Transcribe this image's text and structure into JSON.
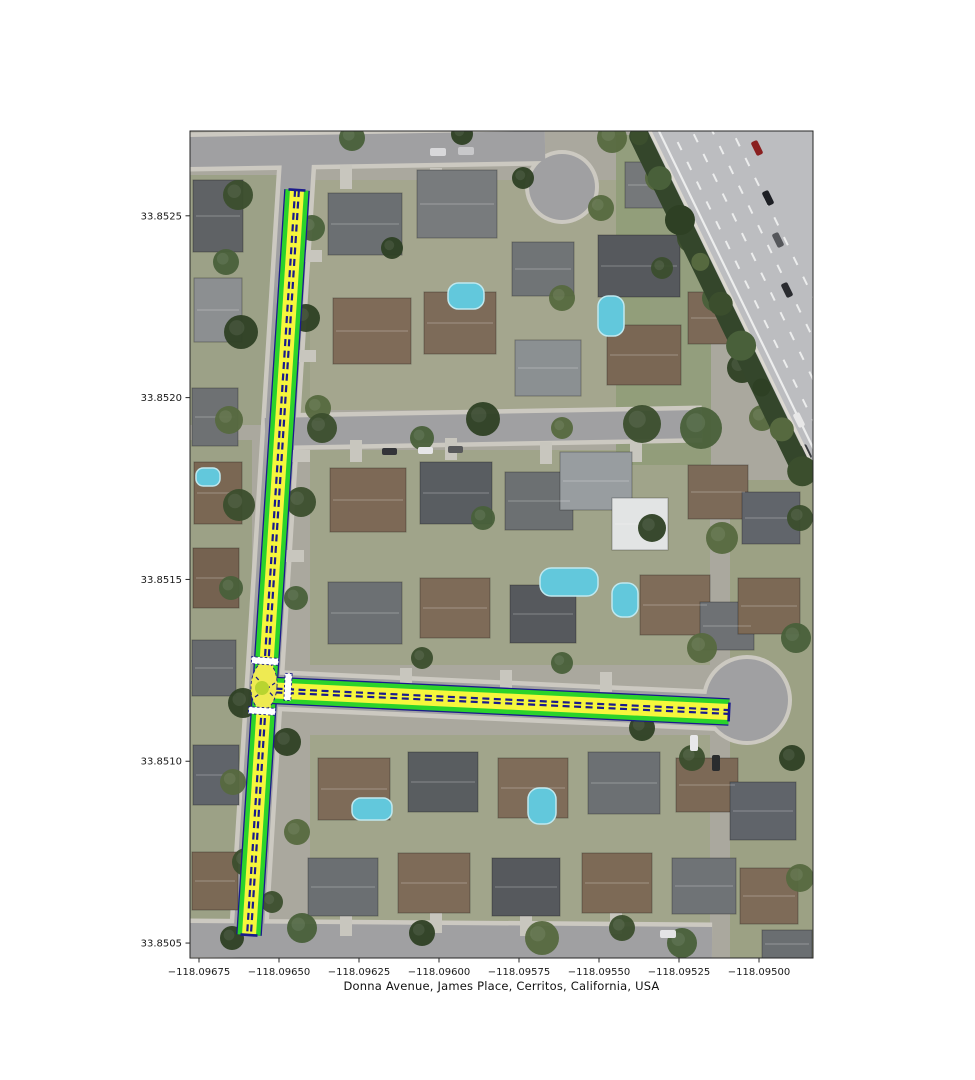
{
  "figure": {
    "width": 975,
    "height": 1080,
    "background": "#ffffff",
    "xlabel": "Donna Avenue, James Place, Cerritos, California, USA"
  },
  "axes": {
    "plot_rect": [
      190,
      131,
      623,
      827
    ],
    "frame_color": "#262626",
    "tick_color": "#262626",
    "label_color": "#1a1a1a",
    "tick_font_size": 10,
    "lon_range": [
      -118.0967781,
      -118.0948313
    ],
    "lat_range": [
      33.8504589,
      33.8527332
    ],
    "x_ticks": {
      "values": [
        -118.09675,
        -118.0965,
        -118.09625,
        -118.096,
        -118.09575,
        -118.0955,
        -118.09525,
        -118.095
      ],
      "labels": [
        "−118.09675",
        "−118.09650",
        "−118.09625",
        "−118.09600",
        "−118.09575",
        "−118.09550",
        "−118.09525",
        "−118.09500"
      ]
    },
    "y_ticks": {
      "values": [
        33.8525,
        33.852,
        33.8515,
        33.851,
        33.8505
      ],
      "labels": [
        "33.8525",
        "33.8520",
        "33.8515",
        "33.8510",
        "33.8505"
      ]
    }
  },
  "network": {
    "colors": {
      "outline": "#1a1a8c",
      "casing": "#2bd32b",
      "lane": "#f6f63c",
      "divider": "#1a1a8c",
      "crosswalk": "#ffffff",
      "junction_fill": "#eeea52",
      "node_fill": "#b8d430"
    },
    "roads": [
      {
        "id": "donna",
        "name": "Donna Avenue",
        "from": [
          297,
          190
        ],
        "to": [
          249,
          935
        ],
        "width": 23
      },
      {
        "id": "james",
        "name": "James Place",
        "from": [
          264,
          690
        ],
        "to": [
          729,
          712
        ],
        "width": 25
      }
    ],
    "junction": {
      "cx": 264,
      "cy": 686,
      "rx": 13,
      "ry": 24,
      "node_cx": 262,
      "node_cy": 688,
      "node_r": 7,
      "connectors": [
        [
          [
            255,
            697
          ],
          [
            275,
            683
          ]
        ],
        [
          [
            256,
            677
          ],
          [
            273,
            696
          ]
        ]
      ]
    },
    "crosswalks": [
      {
        "road": "donna",
        "cx": 265,
        "cy": 661,
        "len": 27,
        "thick": 7
      },
      {
        "road": "james",
        "cx": 288,
        "cy": 687,
        "len": 27,
        "thick": 7
      },
      {
        "road": "donna",
        "cx": 262,
        "cy": 711,
        "len": 27,
        "thick": 7
      }
    ]
  },
  "basemap": {
    "base_color": "#aaa89e",
    "asphalt_color": "#a0a0a2",
    "sidewalk_color": "#ccc9c1",
    "driveway_color": "#c8c6be",
    "pool_color": "#62c8dc",
    "pool_edge": "#bfe8ef",
    "lawns": [
      [
        190,
        175,
        120,
        250,
        "#9aa083"
      ],
      [
        310,
        180,
        340,
        230,
        "#a3a68b"
      ],
      [
        310,
        450,
        400,
        215,
        "#9fa386"
      ],
      [
        310,
        735,
        400,
        190,
        "#a0a487"
      ],
      [
        616,
        135,
        95,
        330,
        "#8f9c77"
      ],
      [
        730,
        480,
        83,
        478,
        "#9aa07f"
      ],
      [
        190,
        440,
        62,
        490,
        "#9aa081"
      ]
    ],
    "streets": [
      {
        "pts": [
          [
            190,
            152
          ],
          [
            545,
            146
          ]
        ],
        "w": 30
      },
      {
        "pts": [
          [
            298,
            145
          ],
          [
            247,
            958
          ]
        ],
        "w": 30
      },
      {
        "pts": [
          [
            265,
            432
          ],
          [
            702,
            424
          ]
        ],
        "w": 28
      },
      {
        "pts": [
          [
            264,
            690
          ],
          [
            728,
            711
          ]
        ],
        "w": 32
      },
      {
        "pts": [
          [
            190,
            940
          ],
          [
            712,
            944
          ]
        ],
        "w": 34
      }
    ],
    "culdesacs": [
      {
        "cx": 562,
        "cy": 187,
        "r": 33
      },
      {
        "cx": 747,
        "cy": 700,
        "r": 41
      }
    ],
    "driveways": [
      [
        340,
        165,
        12,
        24
      ],
      [
        430,
        168,
        12,
        22
      ],
      [
        350,
        440,
        12,
        22
      ],
      [
        445,
        438,
        12,
        22
      ],
      [
        540,
        442,
        12,
        22
      ],
      [
        630,
        440,
        12,
        22
      ],
      [
        400,
        668,
        12,
        20
      ],
      [
        500,
        670,
        12,
        20
      ],
      [
        600,
        672,
        12,
        20
      ],
      [
        340,
        910,
        12,
        26
      ],
      [
        430,
        907,
        12,
        26
      ],
      [
        520,
        910,
        12,
        26
      ],
      [
        610,
        908,
        12,
        26
      ],
      [
        302,
        250,
        20,
        12
      ],
      [
        296,
        350,
        20,
        12
      ],
      [
        290,
        450,
        20,
        12
      ],
      [
        284,
        550,
        20,
        12
      ]
    ],
    "houses": [
      [
        193,
        180,
        50,
        72,
        "#5f6265"
      ],
      [
        194,
        278,
        48,
        64,
        "#8c8f91"
      ],
      [
        192,
        388,
        46,
        58,
        "#6e7173"
      ],
      [
        194,
        462,
        48,
        62,
        "#7a6753"
      ],
      [
        193,
        548,
        46,
        60,
        "#756250"
      ],
      [
        192,
        640,
        44,
        56,
        "#676a6d"
      ],
      [
        193,
        745,
        46,
        60,
        "#60646a"
      ],
      [
        192,
        852,
        46,
        58,
        "#7b6955"
      ],
      [
        328,
        193,
        74,
        62,
        "#6b6f72"
      ],
      [
        417,
        170,
        80,
        68,
        "#787b7d"
      ],
      [
        512,
        242,
        62,
        54,
        "#707476"
      ],
      [
        598,
        235,
        82,
        62,
        "#56595d"
      ],
      [
        688,
        292,
        58,
        52,
        "#7c6957"
      ],
      [
        625,
        162,
        58,
        46,
        "#75787a"
      ],
      [
        333,
        298,
        78,
        66,
        "#7f6b58"
      ],
      [
        424,
        292,
        72,
        62,
        "#7d6b59"
      ],
      [
        515,
        340,
        66,
        56,
        "#8b9092"
      ],
      [
        607,
        325,
        74,
        60,
        "#7a6754"
      ],
      [
        330,
        468,
        76,
        64,
        "#7d6956"
      ],
      [
        420,
        462,
        72,
        62,
        "#595d61"
      ],
      [
        505,
        472,
        68,
        58,
        "#6c7072"
      ],
      [
        560,
        452,
        72,
        58,
        "#989da0"
      ],
      [
        612,
        498,
        56,
        52,
        "#e2e4e4"
      ],
      [
        688,
        465,
        60,
        54,
        "#7c6a58"
      ],
      [
        328,
        582,
        74,
        62,
        "#6c7073"
      ],
      [
        420,
        578,
        70,
        60,
        "#7e6b58"
      ],
      [
        510,
        585,
        66,
        58,
        "#56595d"
      ],
      [
        640,
        575,
        70,
        60,
        "#7f6c59"
      ],
      [
        700,
        602,
        54,
        48,
        "#6e7174"
      ],
      [
        318,
        758,
        72,
        62,
        "#7e6b58"
      ],
      [
        408,
        752,
        70,
        60,
        "#595d60"
      ],
      [
        498,
        758,
        70,
        60,
        "#7f6c59"
      ],
      [
        588,
        752,
        72,
        62,
        "#6c7073"
      ],
      [
        676,
        758,
        62,
        54,
        "#7c6956"
      ],
      [
        308,
        858,
        70,
        58,
        "#6b6f72"
      ],
      [
        398,
        853,
        72,
        60,
        "#7e6b58"
      ],
      [
        492,
        858,
        68,
        58,
        "#56595d"
      ],
      [
        582,
        853,
        70,
        60,
        "#7d6a56"
      ],
      [
        672,
        858,
        64,
        56,
        "#6f7376"
      ],
      [
        742,
        492,
        58,
        52,
        "#61656b"
      ],
      [
        738,
        578,
        62,
        56,
        "#7c6955"
      ],
      [
        730,
        782,
        66,
        58,
        "#60646a"
      ],
      [
        740,
        868,
        58,
        56,
        "#7e6b58"
      ],
      [
        762,
        930,
        50,
        28,
        "#6a6e71"
      ]
    ],
    "pools": [
      [
        448,
        283,
        36,
        26
      ],
      [
        598,
        296,
        26,
        40
      ],
      [
        540,
        568,
        58,
        28
      ],
      [
        612,
        583,
        26,
        34
      ],
      [
        352,
        798,
        40,
        22
      ],
      [
        528,
        788,
        28,
        36
      ],
      [
        196,
        468,
        24,
        18
      ]
    ],
    "trees": [
      [
        238,
        195,
        15
      ],
      [
        226,
        262,
        13
      ],
      [
        241,
        332,
        17
      ],
      [
        229,
        420,
        14
      ],
      [
        239,
        505,
        16
      ],
      [
        231,
        588,
        12
      ],
      [
        243,
        703,
        15
      ],
      [
        233,
        782,
        13
      ],
      [
        246,
        862,
        14
      ],
      [
        312,
        228,
        13
      ],
      [
        306,
        318,
        14
      ],
      [
        318,
        408,
        13
      ],
      [
        301,
        502,
        15
      ],
      [
        296,
        598,
        12
      ],
      [
        287,
        742,
        14
      ],
      [
        297,
        832,
        13
      ],
      [
        272,
        902,
        11
      ],
      [
        352,
        138,
        13
      ],
      [
        462,
        134,
        11
      ],
      [
        612,
        138,
        15
      ],
      [
        662,
        148,
        17
      ],
      [
        703,
        168,
        19
      ],
      [
        523,
        178,
        11
      ],
      [
        601,
        208,
        13
      ],
      [
        322,
        428,
        15
      ],
      [
        422,
        438,
        12
      ],
      [
        483,
        419,
        17
      ],
      [
        562,
        428,
        11
      ],
      [
        642,
        424,
        19
      ],
      [
        701,
        428,
        21
      ],
      [
        392,
        248,
        11
      ],
      [
        562,
        298,
        13
      ],
      [
        662,
        268,
        11
      ],
      [
        483,
        518,
        12
      ],
      [
        652,
        528,
        14
      ],
      [
        722,
        538,
        16
      ],
      [
        422,
        658,
        11
      ],
      [
        562,
        663,
        11
      ],
      [
        642,
        728,
        13
      ],
      [
        702,
        648,
        15
      ],
      [
        692,
        758,
        13
      ],
      [
        302,
        928,
        15
      ],
      [
        422,
        933,
        13
      ],
      [
        542,
        938,
        17
      ],
      [
        622,
        928,
        13
      ],
      [
        682,
        943,
        15
      ],
      [
        232,
        938,
        12
      ],
      [
        658,
        178,
        13
      ],
      [
        692,
        238,
        15
      ],
      [
        716,
        298,
        14
      ],
      [
        742,
        368,
        15
      ],
      [
        762,
        418,
        13
      ],
      [
        800,
        518,
        13
      ],
      [
        796,
        638,
        15
      ],
      [
        792,
        758,
        13
      ],
      [
        800,
        878,
        14
      ]
    ],
    "tree_colors": [
      "#3b4e2d",
      "#49603a",
      "#2e4024",
      "#56693f"
    ],
    "street_cars": [
      [
        430,
        148,
        16,
        8,
        "#d8d8da"
      ],
      [
        458,
        147,
        16,
        8,
        "#c8c8ca"
      ],
      [
        418,
        447,
        15,
        7,
        "#e6e6e8"
      ],
      [
        448,
        446,
        15,
        7,
        "#58595b"
      ],
      [
        382,
        448,
        15,
        7,
        "#333438"
      ],
      [
        690,
        735,
        8,
        16,
        "#e8e8ea"
      ],
      [
        712,
        755,
        8,
        16,
        "#2a2c2e"
      ],
      [
        660,
        930,
        16,
        8,
        "#e4e4e6"
      ]
    ],
    "freeway": {
      "poly": [
        [
          640,
          131
        ],
        [
          813,
          131
        ],
        [
          813,
          478
        ]
      ],
      "surface": "#bcbdc0",
      "wall": [
        [
          650,
          131
        ],
        [
          813,
          466
        ]
      ],
      "wall_color": "#dcd9d1",
      "treeband_color": "#34462b",
      "lane_color": "#eceded",
      "lane_offsets": [
        20,
        38,
        56,
        74
      ],
      "edge_offset": 8,
      "cars": [
        [
          757,
          148,
          "#8a2020"
        ],
        [
          768,
          198,
          "#1d1f24"
        ],
        [
          787,
          290,
          "#2a2c30"
        ],
        [
          799,
          420,
          "#e8e8e8"
        ],
        [
          806,
          452,
          "#3a3c40"
        ],
        [
          778,
          240,
          "#55575b"
        ]
      ]
    }
  }
}
